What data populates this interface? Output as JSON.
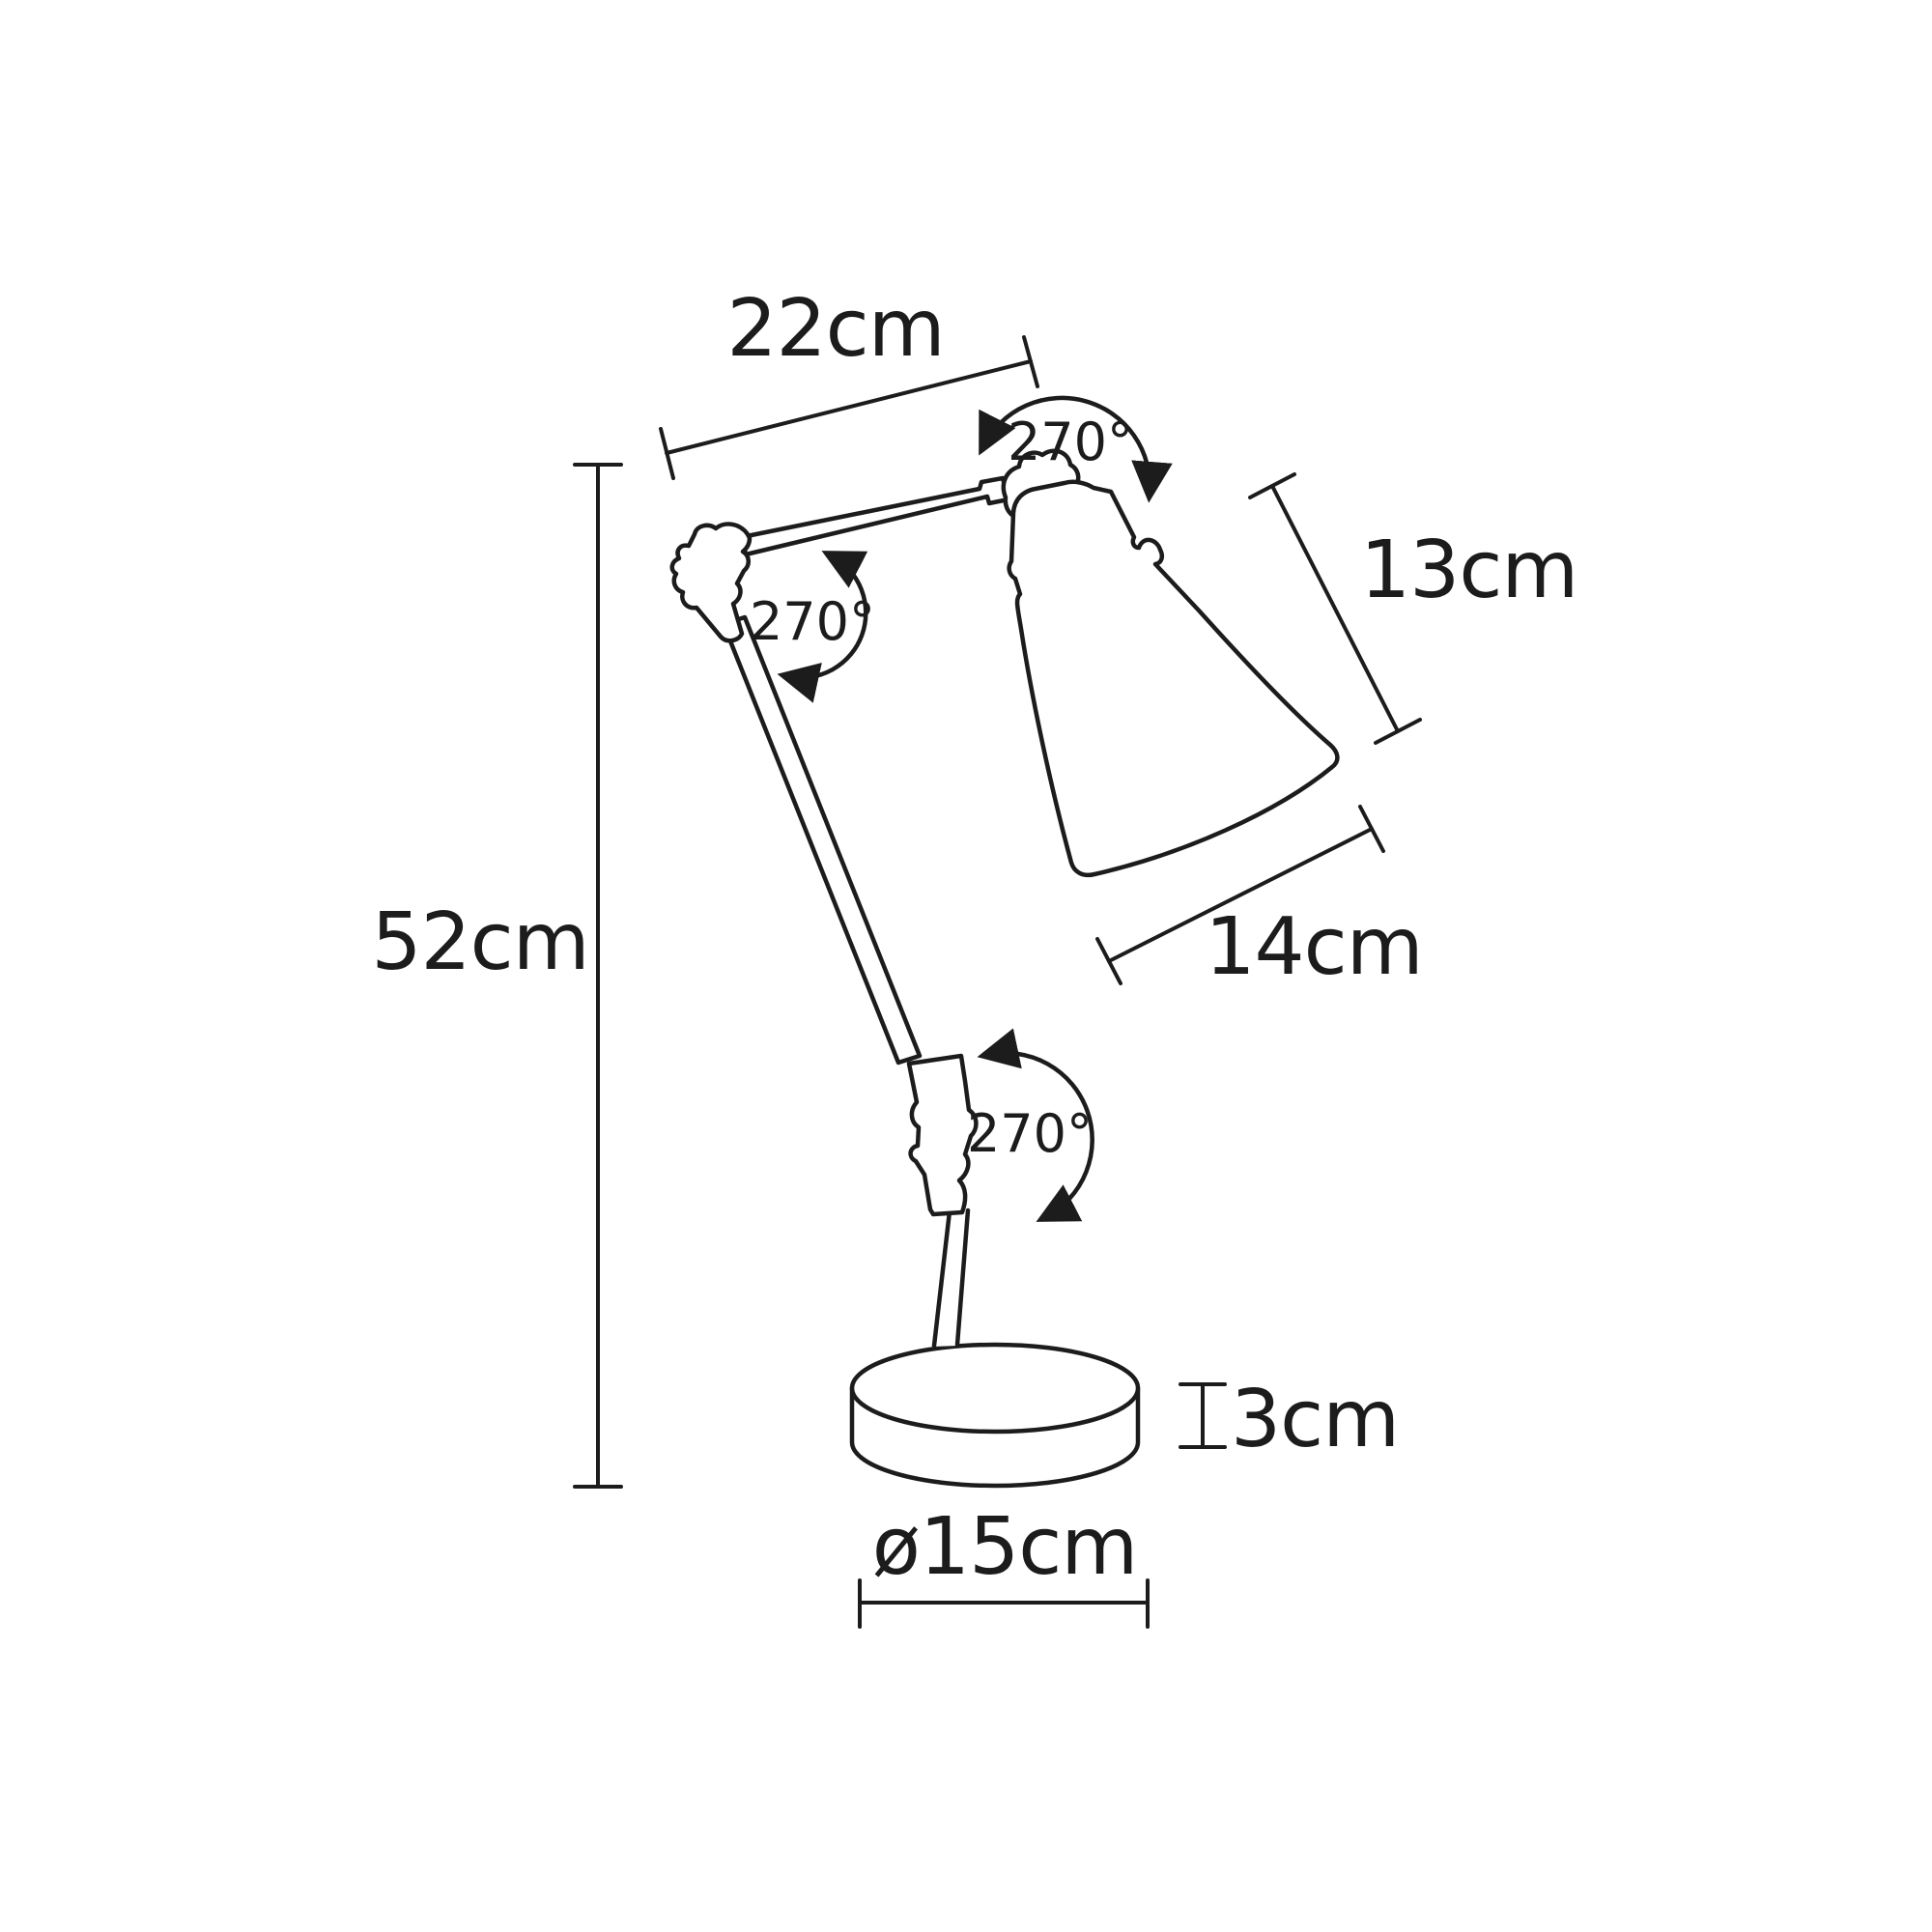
{
  "diagram": {
    "background": "#ffffff",
    "line_color": "#1c1c1c",
    "annotations": {
      "arm_length": "22cm",
      "total_height": "52cm",
      "shade_height": "13cm",
      "shade_width": "14cm",
      "base_height": "3cm",
      "base_diameter": "ø15cm",
      "rotation_top_joint": "270°",
      "rotation_elbow_joint": "270°",
      "rotation_base_joint": "270°"
    }
  }
}
